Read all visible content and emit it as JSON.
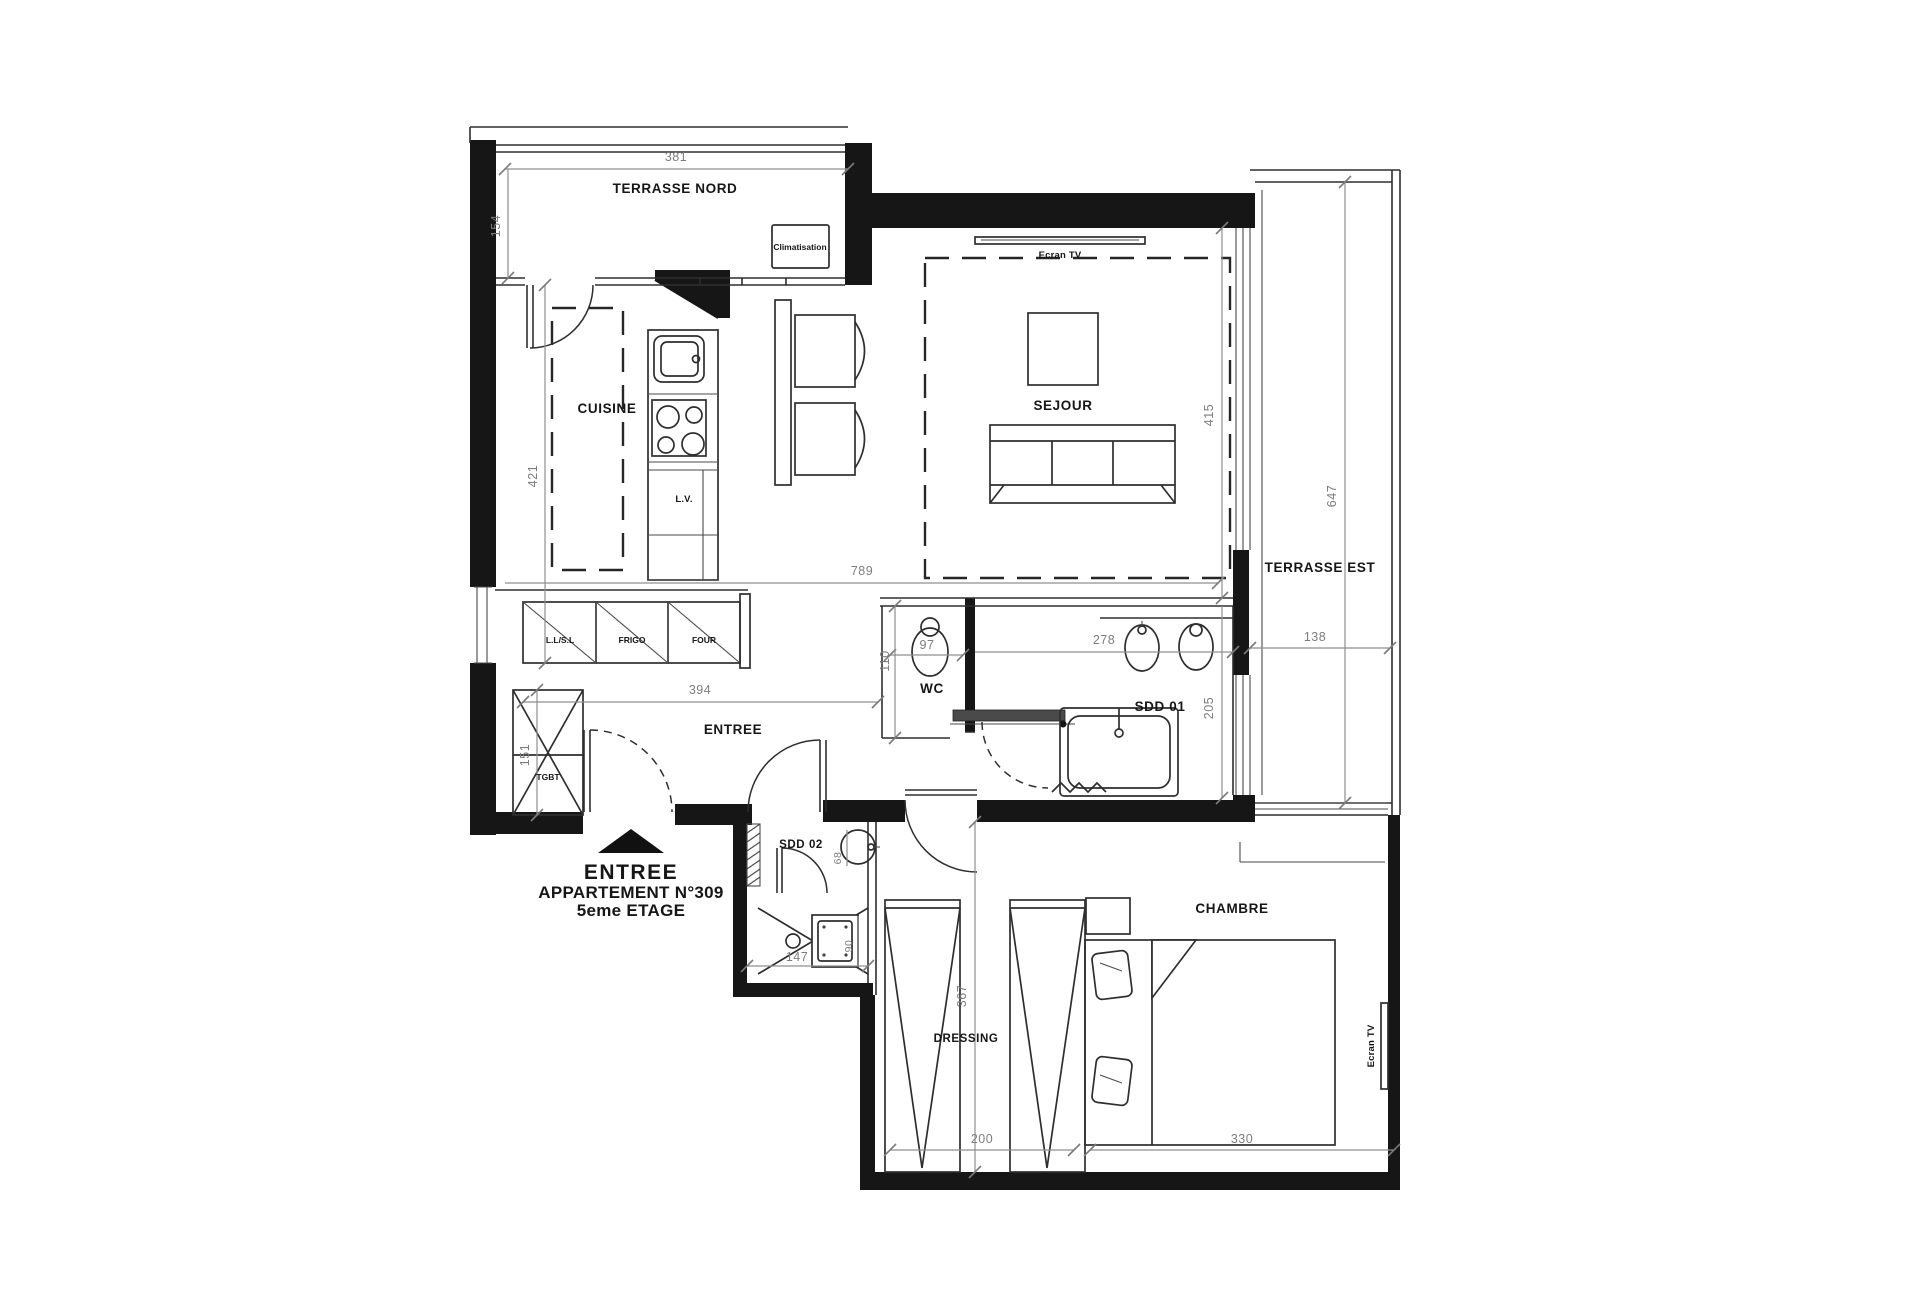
{
  "rooms": {
    "terrasse_nord": "TERRASSE NORD",
    "sejour": "SEJOUR",
    "terrasse_est": "TERRASSE EST",
    "cuisine": "CUISINE",
    "entree": "ENTREE",
    "wc": "WC",
    "sdd01": "SDD 01",
    "sdd02": "SDD 02",
    "dressing": "DRESSING",
    "chambre": "CHAMBRE"
  },
  "equipment": {
    "climatisation": "Climatisation",
    "ecran_tv_sejour": "Ecran TV",
    "ecran_tv_chambre": "Ecran TV",
    "lave_vaisselle": "L.V.",
    "lave_linge": "L.L/S.L",
    "frigo": "FRIGO",
    "four": "FOUR",
    "tgbt": "TGBT"
  },
  "entrance_marker": {
    "line1": "ENTREE",
    "line2": "APPARTEMENT N°309",
    "line3": "5eme ETAGE"
  },
  "dimensions_cm": {
    "terrasse_nord_width": "381",
    "terrasse_nord_depth": "154",
    "cuisine_depth": "421",
    "sejour_band_width": "789",
    "entree_width": "394",
    "tgbt_height": "151",
    "sejour_depth": "415",
    "terrasse_est_height": "647",
    "terrasse_est_width": "138",
    "wc_width": "97",
    "wc_depth": "110",
    "sdd01_width": "278",
    "sdd01_depth": "205",
    "sdd02_basin": "68",
    "shower_width": "147",
    "shower_depth": "90",
    "dressing_height": "367",
    "dressing_width": "200",
    "chambre_width": "330"
  },
  "colors": {
    "wall": "#161616",
    "line": "#2e2e2e",
    "dim": "#7d7d7d",
    "background": "#ffffff"
  }
}
